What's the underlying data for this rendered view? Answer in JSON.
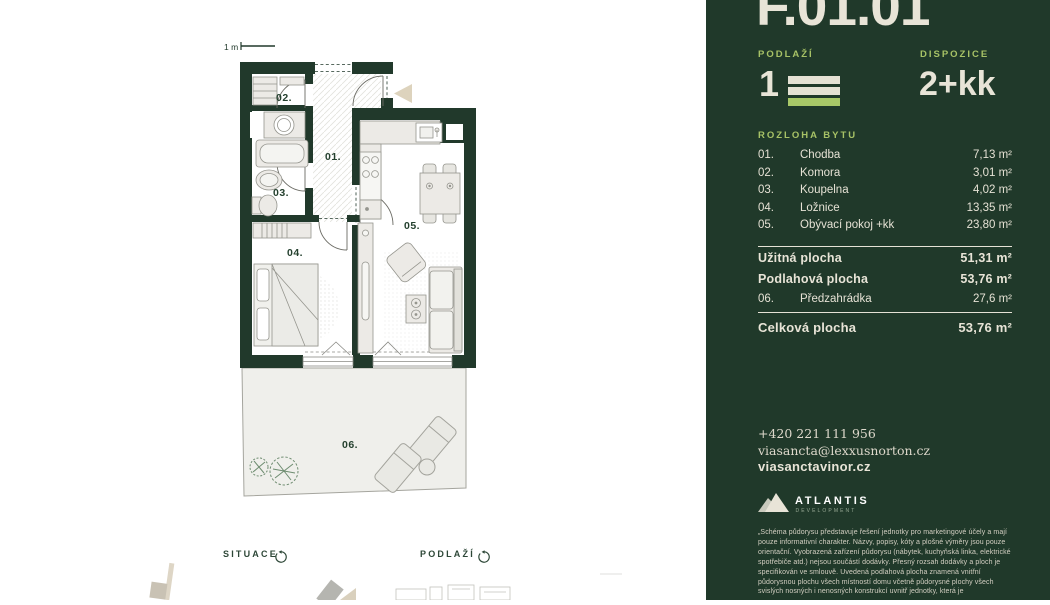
{
  "unit_code": "F.01.01",
  "floor": {
    "label": "PODLAŽÍ",
    "value": "1"
  },
  "disposition": {
    "label": "DISPOZICE",
    "value": "2+kk"
  },
  "area_table": {
    "heading": "ROZLOHA BYTU",
    "rooms": [
      {
        "num": "01.",
        "name": "Chodba",
        "area": "7,13 m²"
      },
      {
        "num": "02.",
        "name": "Komora",
        "area": "3,01 m²"
      },
      {
        "num": "03.",
        "name": "Koupelna",
        "area": "4,02 m²"
      },
      {
        "num": "04.",
        "name": "Ložnice",
        "area": "13,35 m²"
      },
      {
        "num": "05.",
        "name": "Obývací pokoj +kk",
        "area": "23,80 m²"
      }
    ],
    "usable": {
      "label": "Užitná plocha",
      "value": "51,31 m²"
    },
    "floor_area": {
      "label": "Podlahová plocha",
      "value": "53,76 m²"
    },
    "garden": {
      "num": "06.",
      "name": "Předzahrádka",
      "area": "27,6 m²"
    },
    "total": {
      "label": "Celková plocha",
      "value": "53,76 m²"
    }
  },
  "contact": {
    "phone": "+420 221 111 956",
    "email": "viasancta@lexxusnorton.cz",
    "web": "viasanctavinor.cz"
  },
  "logo": {
    "name": "ATLANTIS",
    "sub": "DEVELOPMENT"
  },
  "disclaimer": "„Schéma půdorysu představuje řešení jednotky pro marketingové účely a mají pouze informativní charakter. Názvy, popisy, kóty a plošné výměry jsou pouze orientační. Vyobrazená zařízení půdorysu (nábytek, kuchyňská linka, elektrické spotřebiče atd.) nejsou součástí dodávky. Přesný rozsah dodávky a ploch je specifikován ve smlouvě. Uvedená podlahová plocha znamená vnitřní půdorysnou plochu všech místností domu včetně půdorysné plochy všech svislých nosných i nenosných konstrukcí uvnitř jednotky, která je",
  "plan": {
    "scale_label": "1 m",
    "labels": {
      "r01": "01.",
      "r02": "02.",
      "r03": "03.",
      "r04": "04.",
      "r05": "05.",
      "r06": "06."
    }
  },
  "footer": {
    "situace": "SITUACE",
    "podlazi": "PODLAŽÍ"
  },
  "colors": {
    "panel": "#20392a",
    "cream": "#e8e4d7",
    "accent_green": "#a7c266",
    "wall": "#21392b"
  }
}
